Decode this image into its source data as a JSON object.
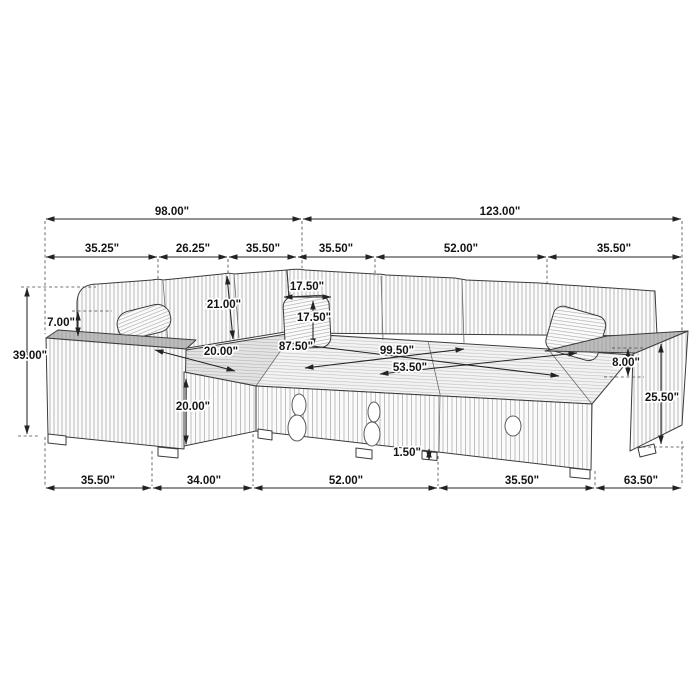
{
  "diagram": {
    "kind": "furniture-dimension-diagram",
    "subject": "u-shaped sectional sleeper sofa line drawing",
    "units": "inches",
    "colors": {
      "background": "#ffffff",
      "line": "#232323",
      "fabric_hatch": "#9b9b9b",
      "armrest_top": "#bcbcbc",
      "label_text": "#141414",
      "label_halo": "#ffffff"
    }
  },
  "dims": {
    "top": [
      {
        "name": "overall-width-left-section",
        "label": "98.00\""
      },
      {
        "name": "overall-width-right-section",
        "label": "123.00\""
      }
    ],
    "upper": [
      {
        "name": "left-arm-section-width",
        "label": "35.25\""
      },
      {
        "name": "left-back-cushion-width",
        "label": "26.25\""
      },
      {
        "name": "corner-cushion-width",
        "label": "35.50\""
      },
      {
        "name": "right-back-cushion-1-width",
        "label": "35.50\""
      },
      {
        "name": "right-back-cushion-2-width",
        "label": "52.00\""
      },
      {
        "name": "right-arm-section-width",
        "label": "35.50\""
      }
    ],
    "left": [
      {
        "name": "back-above-arm-height",
        "label": "7.00\""
      },
      {
        "name": "overall-height",
        "label": "39.00\""
      }
    ],
    "interior": [
      {
        "name": "back-cushion-height",
        "label": "21.00\""
      },
      {
        "name": "pillow-width",
        "label": "17.50\""
      },
      {
        "name": "pillow-height",
        "label": "17.50\""
      },
      {
        "name": "chaise-seat-depth",
        "label": "20.00\""
      },
      {
        "name": "interior-diagonal-width",
        "label": "87.50\""
      },
      {
        "name": "interior-length",
        "label": "99.50\""
      },
      {
        "name": "sleeper-platform-depth",
        "label": "53.50\""
      },
      {
        "name": "seat-height",
        "label": "20.00\""
      },
      {
        "name": "arm-above-seat-height",
        "label": "8.00\""
      },
      {
        "name": "arm-height",
        "label": "25.50\""
      },
      {
        "name": "leg-height",
        "label": "1.50\""
      }
    ],
    "bottom": [
      {
        "name": "base-left-arm-depth",
        "label": "35.50\""
      },
      {
        "name": "base-chaise-width",
        "label": "34.00\""
      },
      {
        "name": "base-sleeper-width",
        "label": "52.00\""
      },
      {
        "name": "base-right-seat-width",
        "label": "35.50\""
      },
      {
        "name": "base-right-section-depth",
        "label": "63.50\""
      }
    ]
  }
}
